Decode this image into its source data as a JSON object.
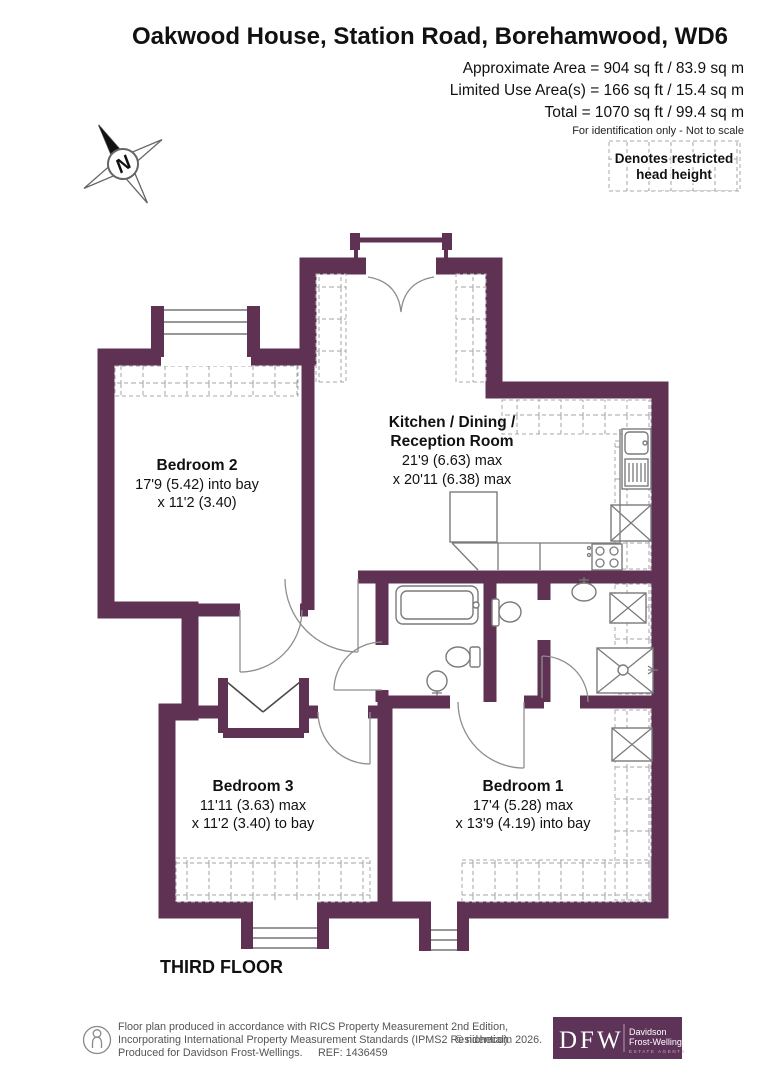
{
  "header": {
    "title": "Oakwood House, Station Road, Borehamwood, WD6",
    "area_lines": [
      "Approximate Area = 904 sq ft / 83.9 sq m",
      "Limited Use Area(s) = 166 sq ft / 15.4 sq m",
      "Total = 1070 sq ft / 99.4 sq m"
    ],
    "disclaimer": "For identification only - Not to scale"
  },
  "legend": {
    "line1": "Denotes restricted",
    "line2": "head height"
  },
  "compass": {
    "label": "N"
  },
  "rooms": {
    "kitchen": {
      "name1": "Kitchen / Dining /",
      "name2": "Reception Room",
      "dim1": "21'9 (6.63) max",
      "dim2": "x 20'11 (6.38) max"
    },
    "bedroom2": {
      "name": "Bedroom 2",
      "dim1": "17'9 (5.42) into bay",
      "dim2": "x 11'2 (3.40)"
    },
    "bedroom3": {
      "name": "Bedroom 3",
      "dim1": "11'11 (3.63) max",
      "dim2": "x 11'2 (3.40) to bay"
    },
    "bedroom1": {
      "name": "Bedroom 1",
      "dim1": "17'4 (5.28) max",
      "dim2": "x 13'9 (4.19) into bay"
    }
  },
  "floor_label": "THIRD FLOOR",
  "footer": {
    "line1": "Floor plan produced in accordance with RICS Property Measurement 2nd Edition,",
    "line2": "Incorporating International Property Measurement Standards (IPMS2 Residential).",
    "line3": "Produced for Davidson Frost-Wellings.",
    "ref": "REF: 1436459",
    "copyright": "© nichecom 2026.",
    "logo": {
      "initials": "DFW",
      "name1": "Davidson",
      "name2": "Frost-Wellings",
      "tagline": "ESTATE AGENTS"
    }
  },
  "colors": {
    "wall": "#5f3254",
    "logo_bg": "#5d3458"
  }
}
